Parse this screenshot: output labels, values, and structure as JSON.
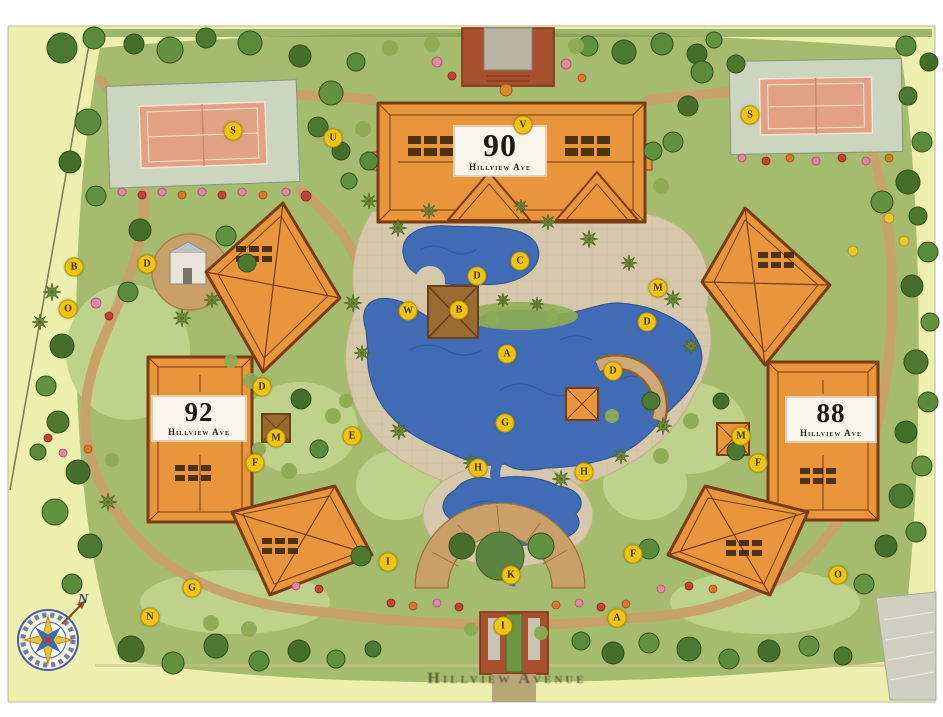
{
  "site": {
    "street_label": "Hillview Avenue",
    "compass_label": "N",
    "buildings": [
      {
        "number": "90",
        "street": "Hillview Ave"
      },
      {
        "number": "92",
        "street": "Hillview Ave"
      },
      {
        "number": "88",
        "street": "Hillview Ave"
      }
    ],
    "amenity_markers": [
      {
        "letter": "S",
        "x": 233,
        "y": 131
      },
      {
        "letter": "S",
        "x": 750,
        "y": 115
      },
      {
        "letter": "U",
        "x": 333,
        "y": 138
      },
      {
        "letter": "V",
        "x": 523,
        "y": 125
      },
      {
        "letter": "B",
        "x": 74,
        "y": 267
      },
      {
        "letter": "D",
        "x": 147,
        "y": 264
      },
      {
        "letter": "O",
        "x": 68,
        "y": 309
      },
      {
        "letter": "C",
        "x": 520,
        "y": 261
      },
      {
        "letter": "D",
        "x": 477,
        "y": 276
      },
      {
        "letter": "W",
        "x": 408,
        "y": 311
      },
      {
        "letter": "B",
        "x": 459,
        "y": 310
      },
      {
        "letter": "A",
        "x": 507,
        "y": 354
      },
      {
        "letter": "M",
        "x": 658,
        "y": 288
      },
      {
        "letter": "D",
        "x": 647,
        "y": 322
      },
      {
        "letter": "D",
        "x": 613,
        "y": 371
      },
      {
        "letter": "E",
        "x": 352,
        "y": 436
      },
      {
        "letter": "G",
        "x": 505,
        "y": 423
      },
      {
        "letter": "H",
        "x": 478,
        "y": 468
      },
      {
        "letter": "H",
        "x": 584,
        "y": 472
      },
      {
        "letter": "D",
        "x": 262,
        "y": 387
      },
      {
        "letter": "M",
        "x": 276,
        "y": 438
      },
      {
        "letter": "F",
        "x": 255,
        "y": 463
      },
      {
        "letter": "M",
        "x": 741,
        "y": 436
      },
      {
        "letter": "F",
        "x": 758,
        "y": 463
      },
      {
        "letter": "K",
        "x": 511,
        "y": 575
      },
      {
        "letter": "I",
        "x": 388,
        "y": 562
      },
      {
        "letter": "F",
        "x": 633,
        "y": 554
      },
      {
        "letter": "I",
        "x": 503,
        "y": 626
      },
      {
        "letter": "A",
        "x": 617,
        "y": 618
      },
      {
        "letter": "G",
        "x": 192,
        "y": 588
      },
      {
        "letter": "N",
        "x": 150,
        "y": 617
      },
      {
        "letter": "O",
        "x": 838,
        "y": 575
      }
    ],
    "colors": {
      "site_background": "#edefae",
      "landscape_green": "#a5bc6e",
      "building_fill": "#e8953c",
      "building_outline": "#7a3c12",
      "water": "#3f6cb4",
      "path_tan": "#c9a06a",
      "tennis_court": "#e2a182",
      "marker_yellow": "#f0c414",
      "entry_brick": "#a8502e"
    }
  }
}
